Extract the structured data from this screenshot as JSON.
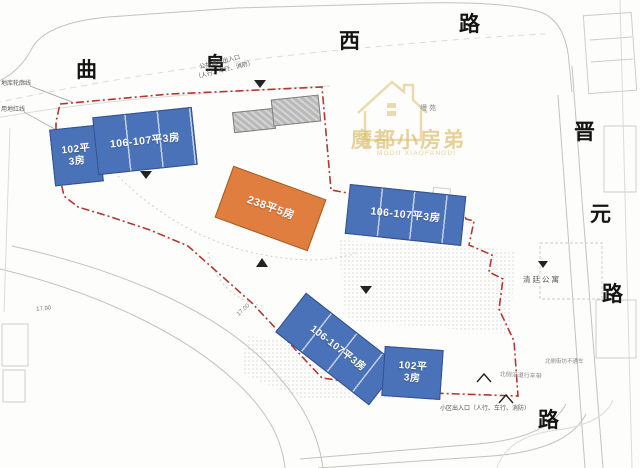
{
  "page": {
    "type": "residential-site-plan"
  },
  "streets": [
    {
      "char": "曲"
    },
    {
      "char": "阜"
    },
    {
      "char": "西"
    },
    {
      "char": "路"
    },
    {
      "char": "晋"
    },
    {
      "char": "元"
    },
    {
      "char": "路"
    },
    {
      "char": "路"
    }
  ],
  "buildings": [
    {
      "line1": "102平",
      "line2": "3房",
      "type": "blue"
    },
    {
      "line1": "106-107平3房",
      "line2": "",
      "type": "blue"
    },
    {
      "line1": "238平5房",
      "line2": "",
      "type": "orange"
    },
    {
      "line1": "106-107平3房",
      "line2": "",
      "type": "blue"
    },
    {
      "line1": "106-107平3房",
      "line2": "",
      "type": "blue"
    },
    {
      "line1": "102平",
      "line2": "3房",
      "type": "blue"
    }
  ],
  "watermark": {
    "brand": "魔都小房弟",
    "subtitle": "MODU XIAOFANGDI"
  },
  "labels": {
    "project_name": "缦苑",
    "neighbor_building": "清廷公寓",
    "garage_outline": "地库轮廓线",
    "red_line": "用地红线",
    "entrance_top_1": "公共通道出入口",
    "entrance_top_2": "（人行、车行、消防）",
    "entrance_bottom": "小区出入口（人行、车行、消防）",
    "note_north_1": "北侧街坊不通车",
    "note_north_2": "北侧沿道行车带",
    "dim_1": "17.90",
    "dim_2": "17.00"
  },
  "colors": {
    "blue": "#4a72b8",
    "orange": "#df7e3e",
    "grey": "#b9b9b9",
    "boundary": "#b23830",
    "gold": "#d9b75f"
  }
}
